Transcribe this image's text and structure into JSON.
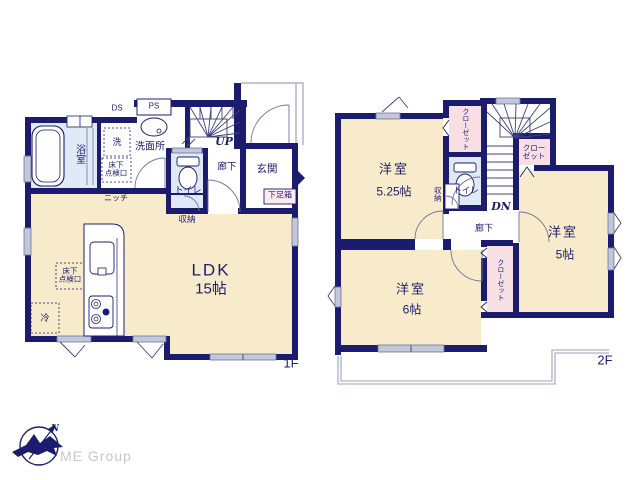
{
  "colors": {
    "wall": "#1c1c6e",
    "room_fill": "#f8ebcb",
    "closet_fill": "#f8dfe3",
    "wet_fill": "#e0eaf7",
    "window_fill": "#c2c7d9",
    "outline": "#9aa0bb",
    "text": "#1c1c6e",
    "logo_text": "#c6c6c6"
  },
  "floor1": {
    "label": "1F",
    "bath": "浴室",
    "duct": "DS",
    "pipe_space": "PS",
    "washer": "洗",
    "washroom": "洗面所",
    "underfloor_hatch": "床下\n点検口",
    "underfloor_hatch_2": "床下\n点検口",
    "niche": "ニッチ",
    "toilet": "トイレ",
    "stairs": "UP",
    "hallway": "廊下",
    "entrance": "玄関",
    "shoe_box": "下足箱",
    "storage": "収納",
    "ldk": "LDK",
    "ldk_size": "15帖",
    "fridge": "冷"
  },
  "floor2": {
    "label": "2F",
    "room_a": "洋室",
    "room_a_size": "5.25帖",
    "room_b": "洋室",
    "room_b_size": "6帖",
    "room_c": "洋室",
    "room_c_size": "5帖",
    "closet_a": "クローゼット",
    "closet_b": "クローゼット",
    "closet_c": "クロー\nゼット",
    "storage": "収納",
    "toilet": "トイレ",
    "stairs": "DN",
    "hallway": "廊下"
  },
  "logo": {
    "company": "ME Group",
    "north": "N"
  }
}
